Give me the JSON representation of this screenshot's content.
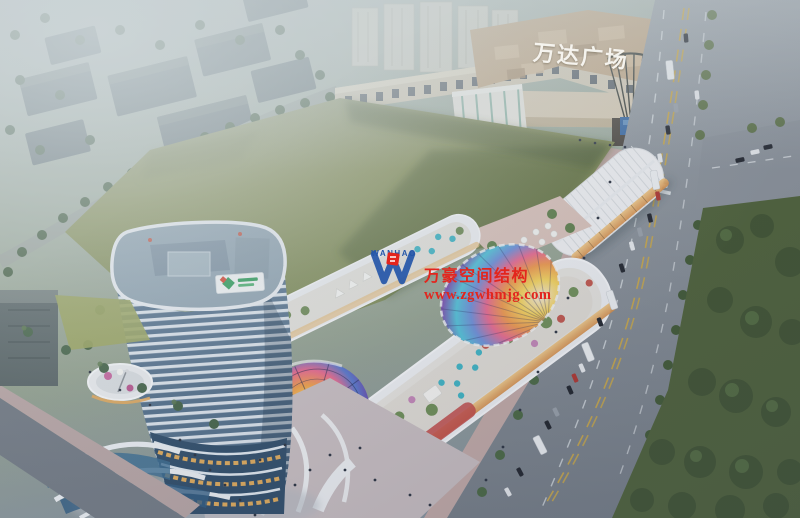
{
  "scene": {
    "mall_sign": "万达广场",
    "watermark": {
      "logo_text": "WANHAO",
      "company": "万豪空间结构",
      "website": "www.zgwhmjg.com"
    }
  },
  "colors": {
    "watermark_red": "#e3251d",
    "logo_blue": "#2456a8",
    "sign_white": "#f8f7f2",
    "lawn_green": "#8a935e",
    "haze_gray": "#cdd6d9",
    "mall_beige": "#d2c6b0",
    "tower_glass_blue": "#55718c",
    "canopy_yellow": "#f5d45e",
    "canopy_orange": "#ef9a4e",
    "canopy_pink": "#e86a90",
    "canopy_blue": "#5878cc",
    "canopy_purple": "#6a48aa",
    "canopy_teal": "#52c2d8"
  }
}
